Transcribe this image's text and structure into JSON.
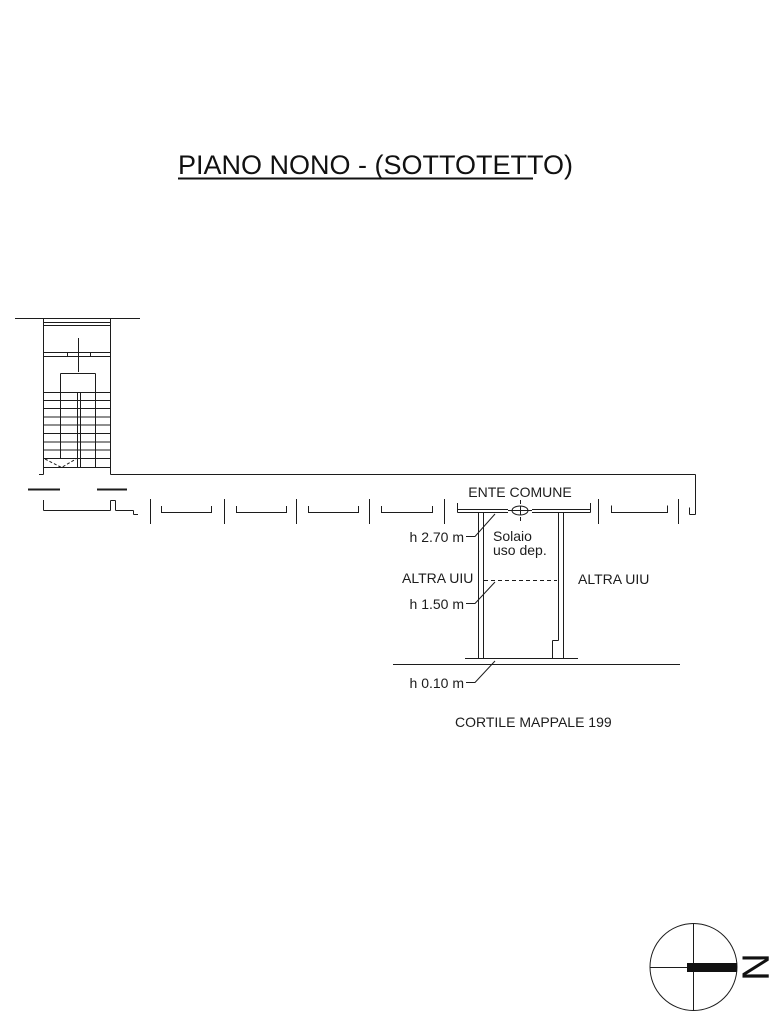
{
  "colors": {
    "line": "#1c1c1c",
    "background": "#ffffff"
  },
  "title": {
    "text": "PIANO NONO - (SOTTOTETTO)"
  },
  "labels": {
    "ente_comune": "ENTE COMUNE",
    "solaio_line1": "Solaio",
    "solaio_line2": "uso dep.",
    "h_270": "h 2.70 m",
    "h_150": "h 1.50 m",
    "h_010": "h 0.10 m",
    "altra_uiu_left": "ALTRA UIU",
    "altra_uiu_right": "ALTRA UIU",
    "cortile_mappale": "CORTILE MAPPALE 199"
  },
  "compass": {
    "north_letter": "N"
  }
}
